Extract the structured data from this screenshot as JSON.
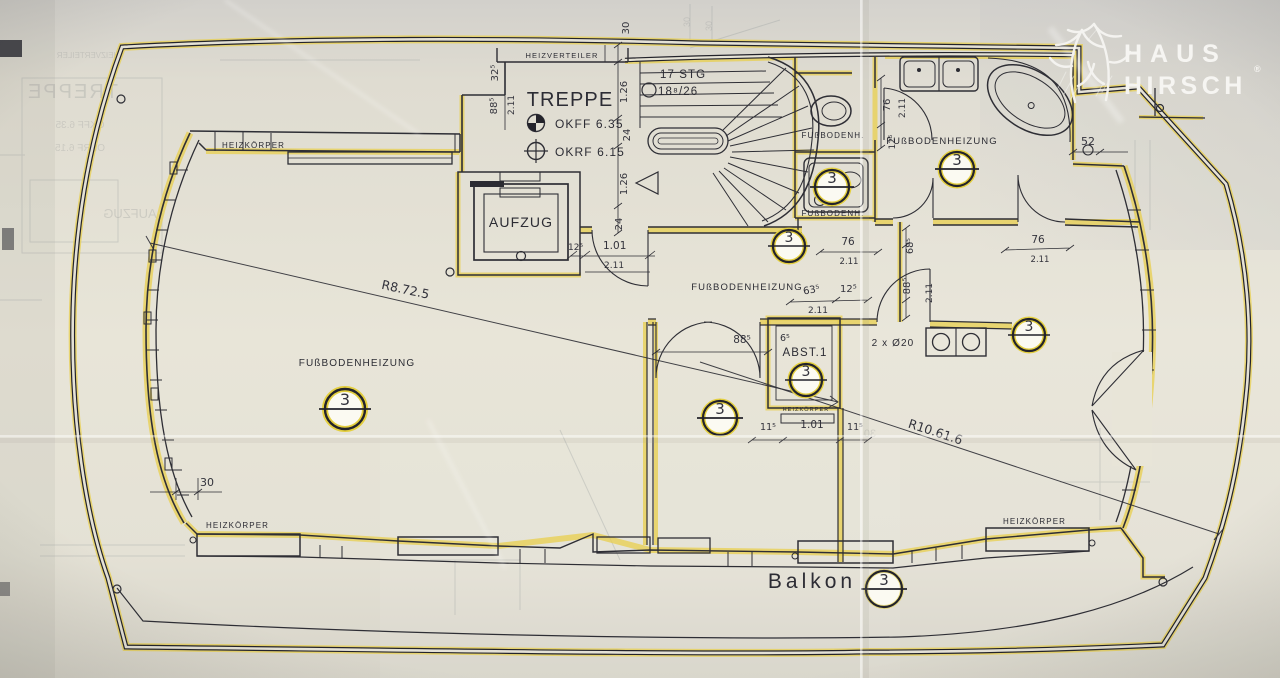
{
  "branding": {
    "name_line1": "HAUS",
    "name_line2": "HIRSCH",
    "registered_mark": "®"
  },
  "labels": {
    "treppe": "TREPPE",
    "aufzug": "AUFZUG",
    "heizverteiler": "HEIZVERTEILER",
    "abstellraum": "ABST.1",
    "balkon": "Balkon",
    "fussbodenheizung": "FUßBODENHEIZUNG",
    "fussbodenh_abbrev": "FUßBODENH.",
    "heizkoerper": "HEIZKÖRPER",
    "okff": "OKFF 6.35",
    "okrf": "OKRF 6.15",
    "stg_line1": "17 STG",
    "stg_line2": "18⁸/26",
    "kitchen_note": "2 x Ø20",
    "radius_1": "R8.72.5",
    "radius_2": "R10.61.6"
  },
  "section_marker": "3",
  "dims": {
    "d30": "30",
    "d32_5": "32⁵",
    "d88_5": "88⁵",
    "d2_11": "2.11",
    "d1_26": "1.26",
    "d24": "24",
    "d12_5": "12⁵",
    "d1_01": "1.01",
    "d76": "76",
    "d68_5": "68⁵",
    "d63_5": "63⁵",
    "d6_5": "6⁵",
    "d11_5": "11⁵",
    "d52": "52"
  },
  "colors": {
    "highlight": "#e8cf4e",
    "ink": "#2e2e35",
    "paper": "#e2dfd3",
    "logo": "#f6f5f2"
  }
}
